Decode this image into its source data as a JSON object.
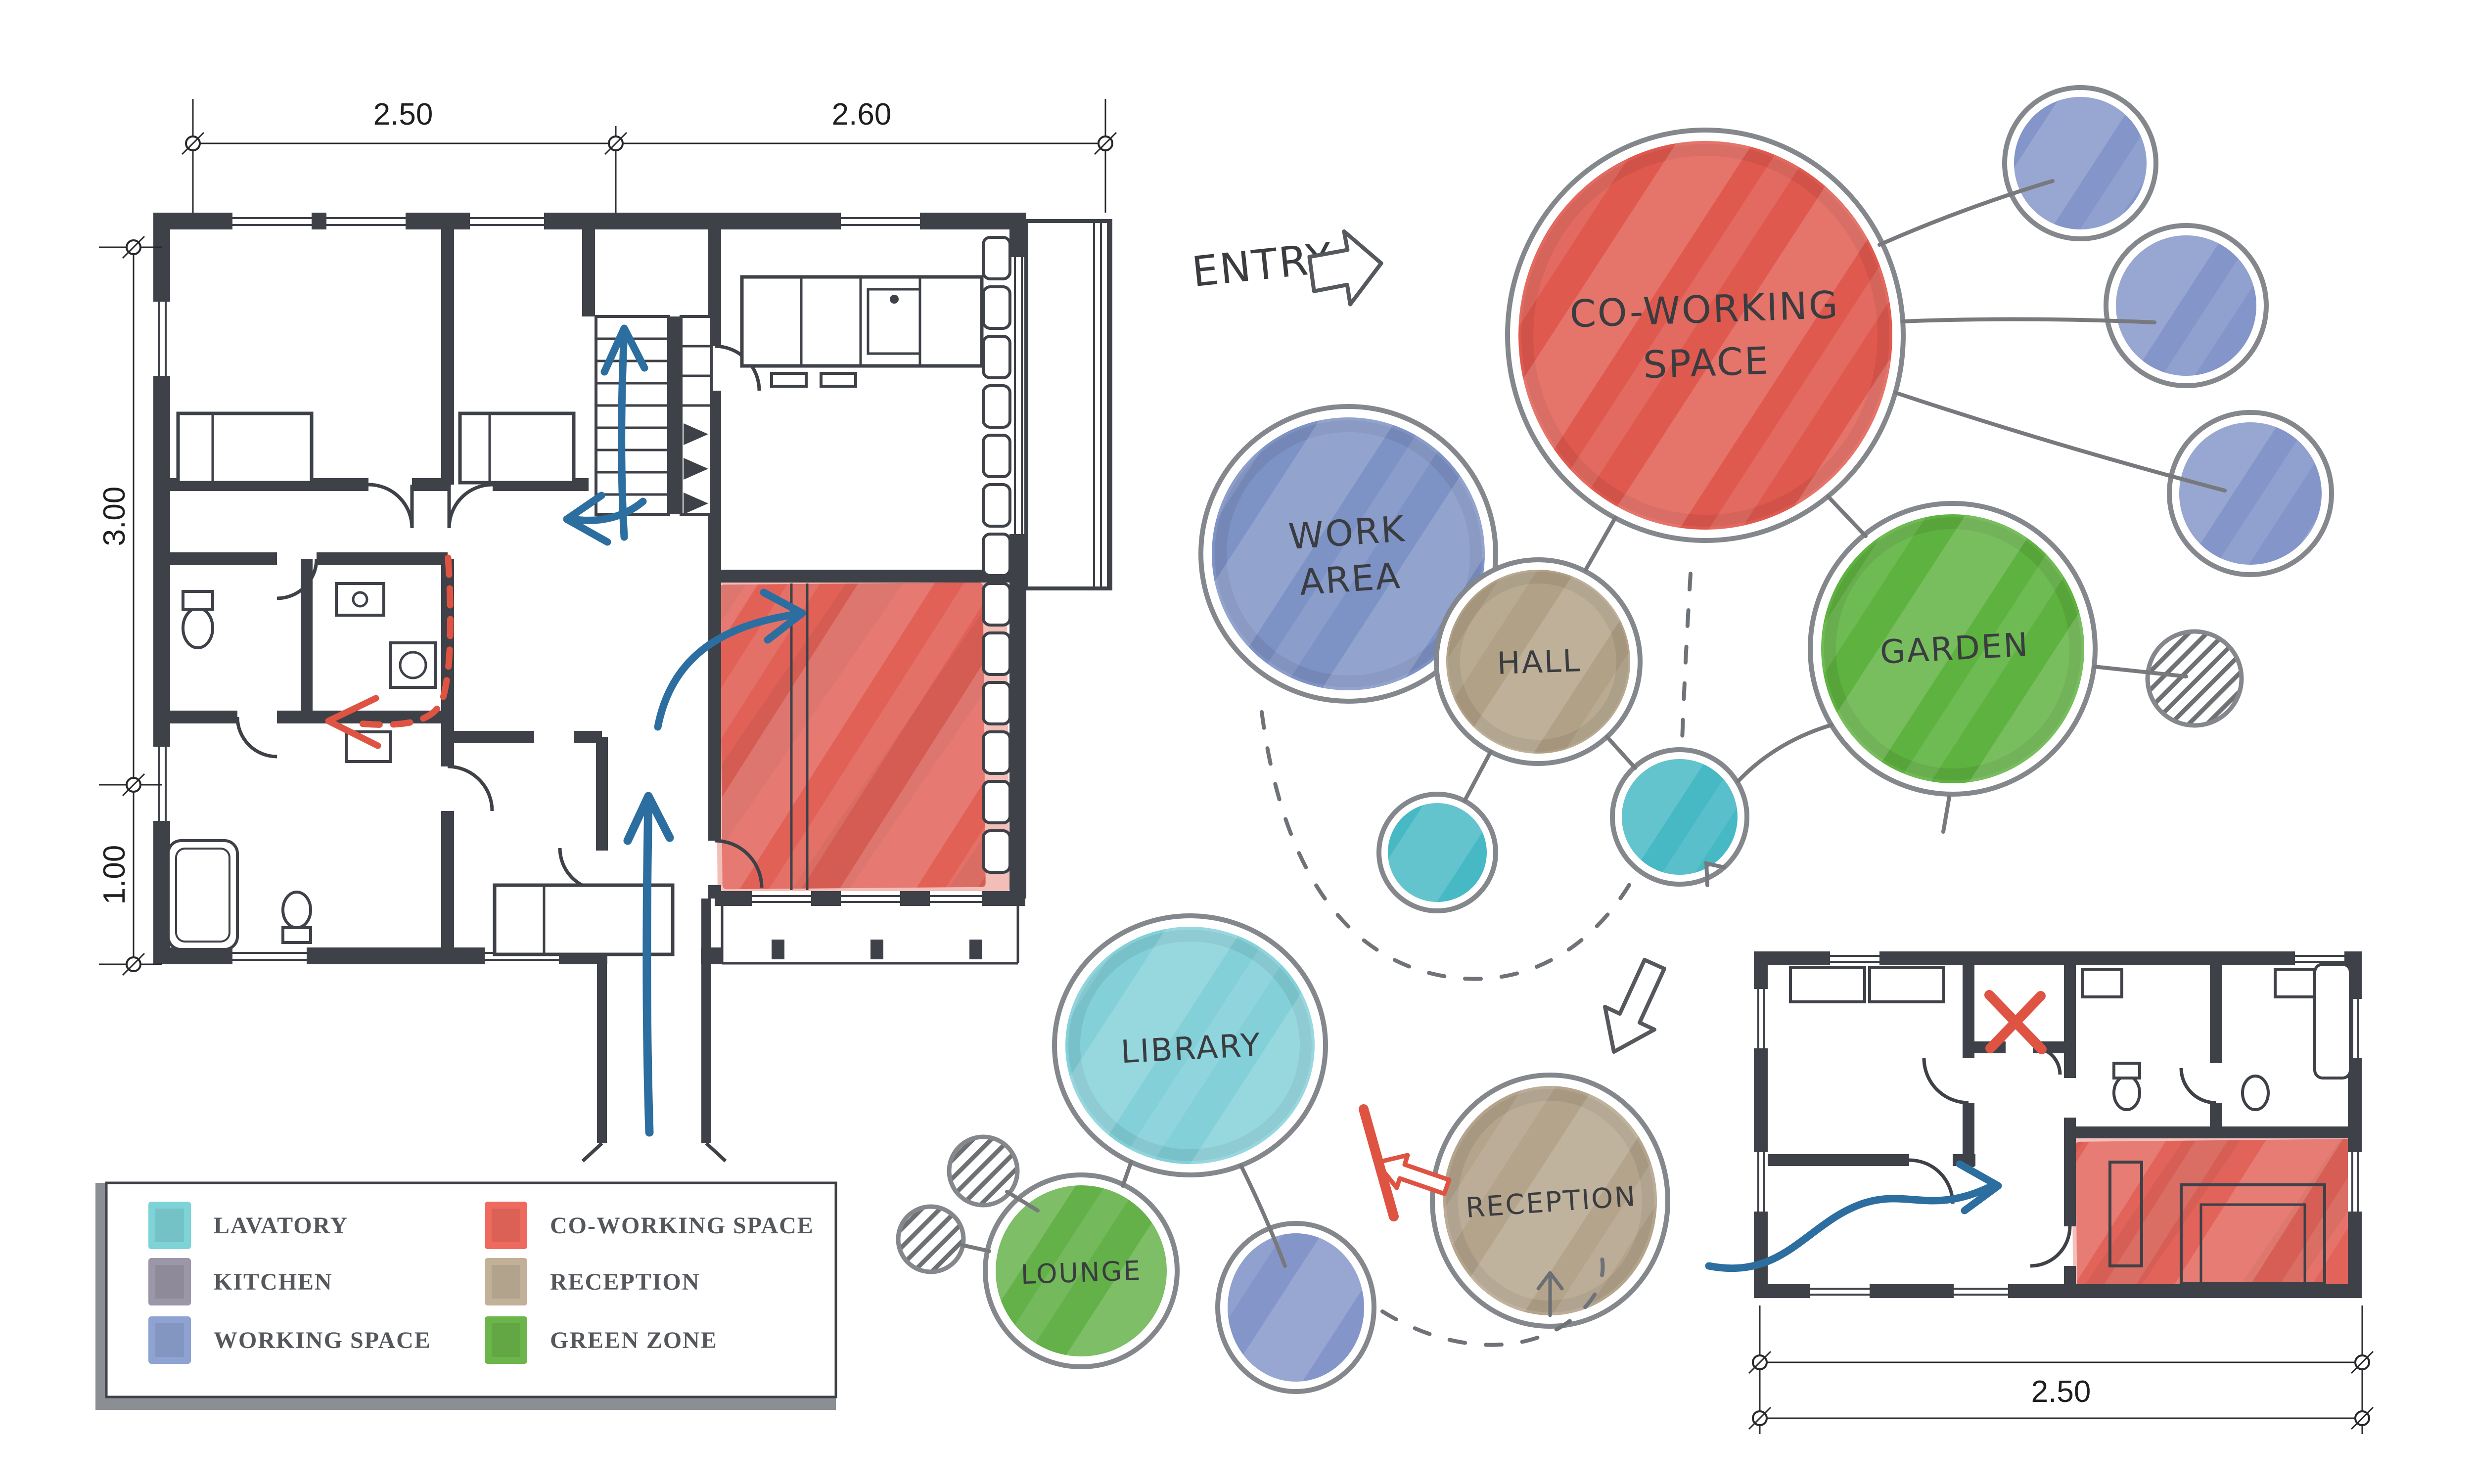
{
  "entry": {
    "label": "ENTRY"
  },
  "bubble_diagram": {
    "coworking": {
      "line1": "CO-WORKING",
      "line2": "SPACE"
    },
    "work_area": {
      "line1": "WORK",
      "line2": "AREA"
    },
    "hall": {
      "label": "HALL"
    },
    "garden": {
      "label": "GARDEN"
    },
    "library": {
      "label": "LIBRARY"
    },
    "lounge": {
      "label": "LOUNGE"
    },
    "reception": {
      "label": "RECEPTION"
    }
  },
  "plan_left": {
    "dims": {
      "top_left": "2.50",
      "top_right": "2.60",
      "side_upper": "3.00",
      "side_lower": "1.00"
    }
  },
  "plan_right": {
    "dims": {
      "bottom": "2.50"
    }
  },
  "legend": {
    "items": [
      {
        "label": "LAVATORY",
        "color": "#7ed3d7"
      },
      {
        "label": "KITCHEN",
        "color": "#9b96a8"
      },
      {
        "label": "WORKING SPACE",
        "color": "#8fa3d3"
      },
      {
        "label": "CO-WORKING SPACE",
        "color": "#ee6a5e"
      },
      {
        "label": "RECEPTION",
        "color": "#c2b198"
      },
      {
        "label": "GREEN ZONE",
        "color": "#6cb54a"
      }
    ]
  },
  "colors": {
    "coworking": "#e0594e",
    "working": "#7d92c5",
    "working_small": "#8496c9",
    "hall": "#b1a186",
    "reception": "#b4a48c",
    "garden": "#5eb23f",
    "lounge": "#64b14a",
    "lavatory": "#46b9c5",
    "library": "#83d0d9",
    "wall": "#3e4147",
    "sketch_line": "#77797d",
    "flow_arrow_blue": "#2c6e9f",
    "annotation_red": "#df5342"
  }
}
